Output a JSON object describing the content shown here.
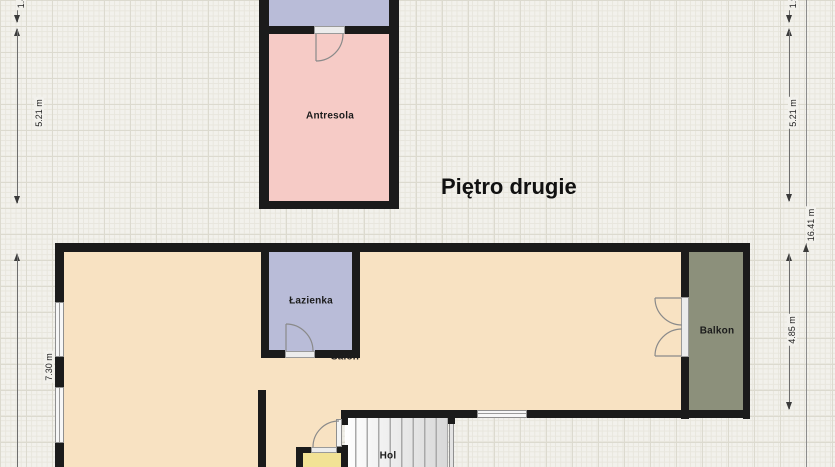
{
  "floor_title": "Piętro drugie",
  "rooms": {
    "antresola": "Antresola",
    "lazienka": "Łazienka",
    "salon": "Salon",
    "hol": "Hol",
    "balkon": "Balkon"
  },
  "dimensions": {
    "left_partial": "1.4",
    "left_upper": "5.21 m",
    "left_lower": "7.30 m",
    "right_partial": "1.9",
    "right_upper": "5.21 m",
    "right_total": "16.41 m",
    "right_lower": "4.85 m"
  },
  "colors": {
    "wall": "#1b1b1b",
    "background": "#f2f1ec",
    "salon_fill": "#f8e2c2",
    "antresola_fill": "#f6cbc6",
    "lavender_fill": "#b9bcd8",
    "balkon_fill": "#8c907b",
    "yellow_room_fill": "#f2e295",
    "stairs_fill": "#e8e8e8",
    "door_window_fill": "#ececec"
  }
}
